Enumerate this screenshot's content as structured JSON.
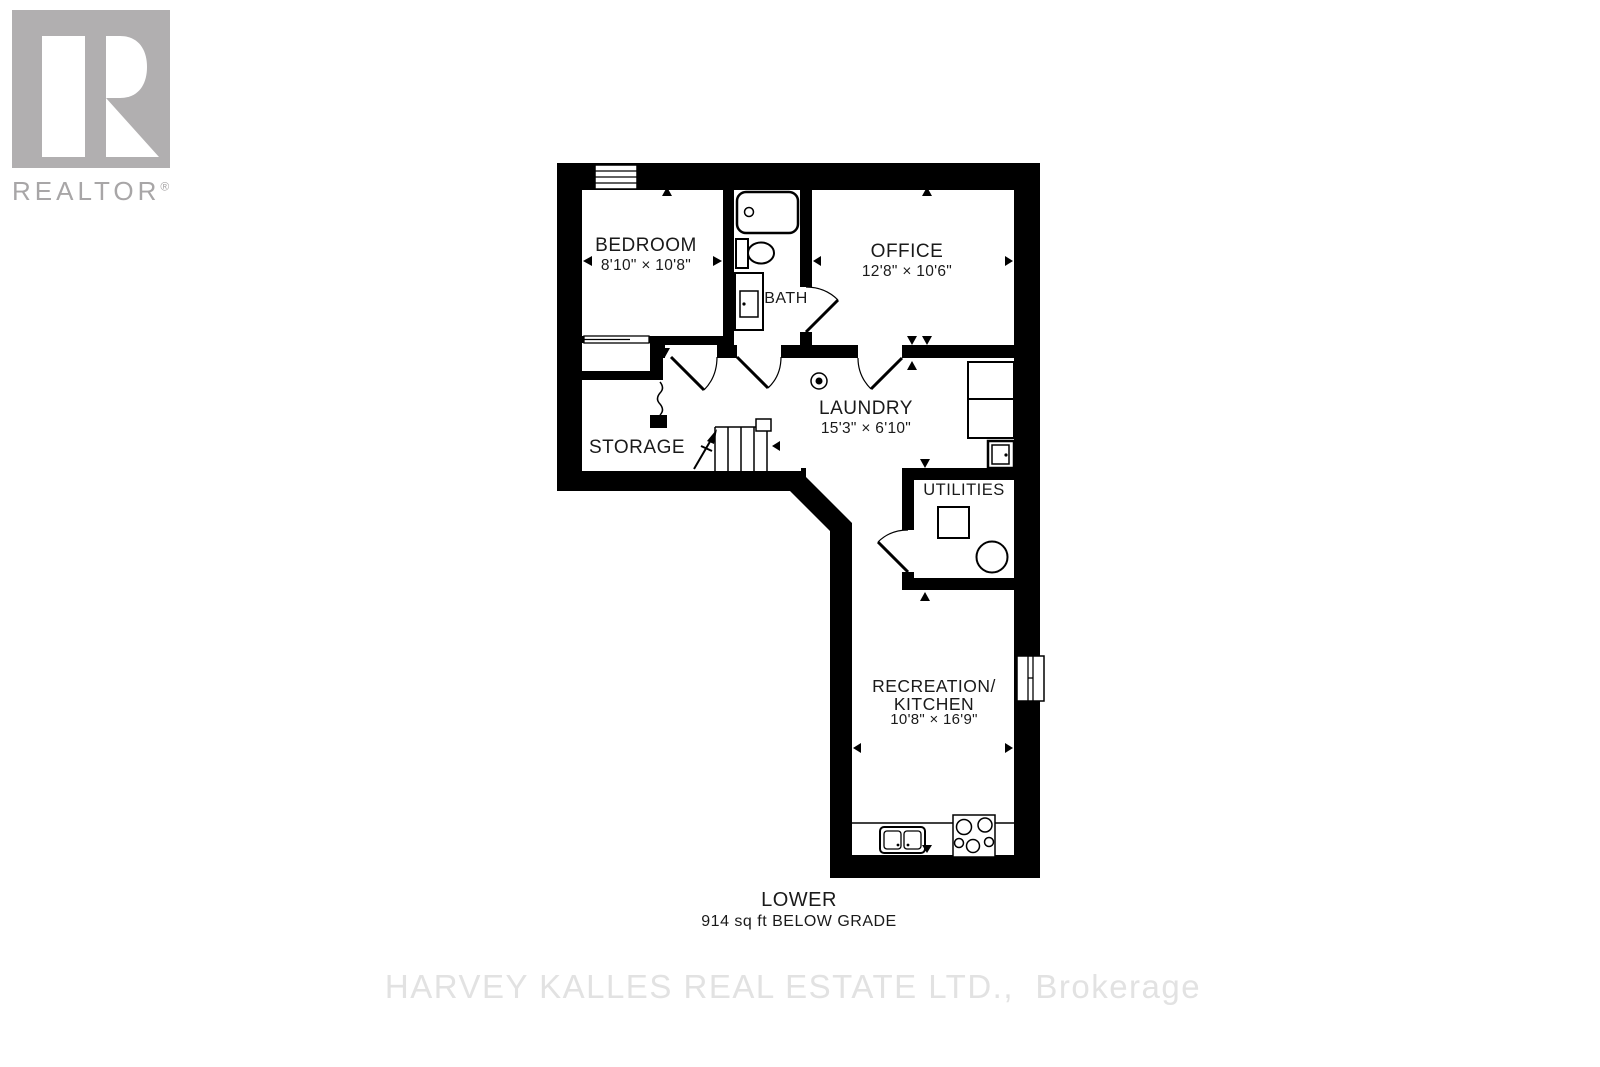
{
  "branding": {
    "realtor_label": "REALTOR",
    "registered_mark": "®"
  },
  "rooms": {
    "bedroom": {
      "name": "BEDROOM",
      "dims": "8'10\" × 10'8\""
    },
    "bath": {
      "name": "BATH"
    },
    "office": {
      "name": "OFFICE",
      "dims": "12'8\" × 10'6\""
    },
    "laundry": {
      "name": "LAUNDRY",
      "dims": "15'3\" × 6'10\""
    },
    "storage": {
      "name": "STORAGE"
    },
    "utilities": {
      "name": "UTILITIES"
    },
    "recreation": {
      "name": "RECREATION/",
      "name2": "KITCHEN",
      "dims": "10'8\" × 16'9\""
    }
  },
  "footer": {
    "level": "LOWER",
    "area": "914 sq ft BELOW GRADE"
  },
  "watermark": "HARVEY KALLES REAL ESTATE LTD.,  Brokerage",
  "colors": {
    "wall": "#000000",
    "label": "#1a1a1a",
    "logo_gray": "#b1afb0",
    "logo_text_gray": "#a8a6a7",
    "watermark_gray": "#e2e2e2"
  },
  "fixtures": [
    "bathtub",
    "toilet",
    "vanity-sink",
    "floor-drain",
    "washer-dryer",
    "laundry-sink",
    "stairs",
    "furnace",
    "water-heater",
    "kitchen-sink",
    "cooktop",
    "window",
    "closet-sliding-door",
    "door-swing"
  ]
}
